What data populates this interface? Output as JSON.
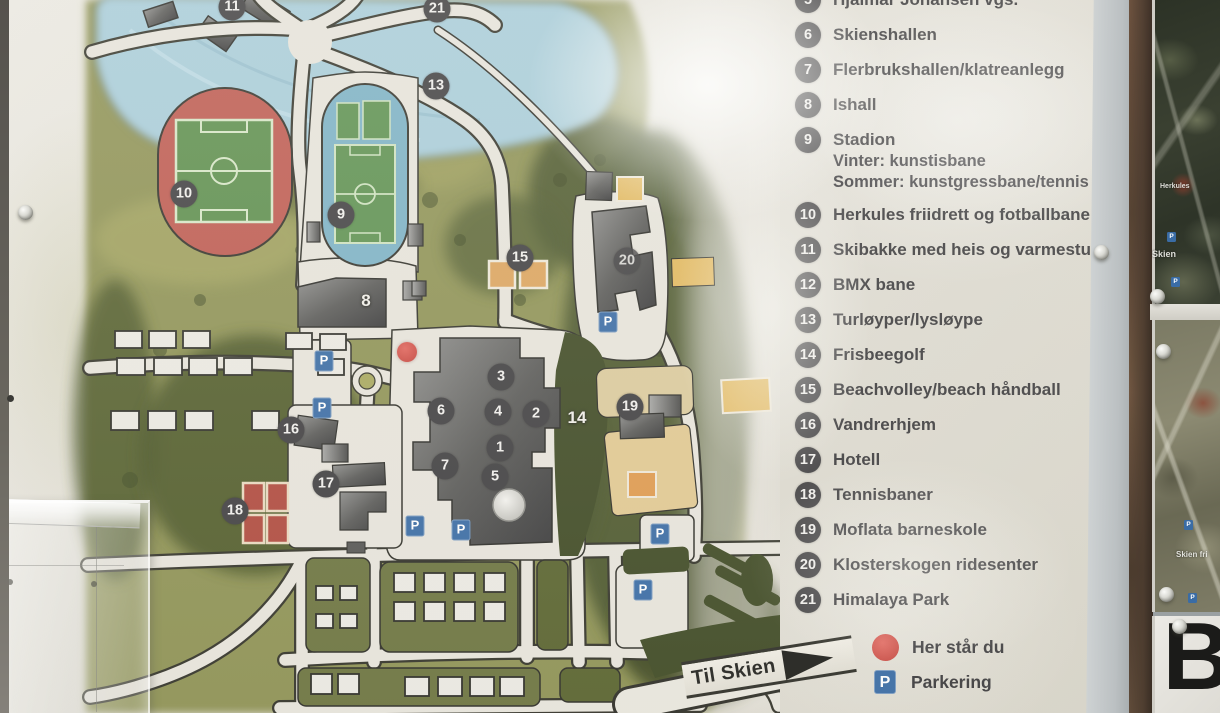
{
  "legend": {
    "items": [
      {
        "num": "5",
        "label": "Hjalmar Johansen vgs."
      },
      {
        "num": "6",
        "label": "Skienshallen"
      },
      {
        "num": "7",
        "label": "Flerbrukshallen/klatreanlegg"
      },
      {
        "num": "8",
        "label": "Ishall"
      },
      {
        "num": "9",
        "label": "Stadion",
        "sublines": [
          "Vinter: kunstisbane",
          "Sommer: kunstgressbane/tennis"
        ]
      },
      {
        "num": "10",
        "label": "Herkules friidrett og fotballbane"
      },
      {
        "num": "11",
        "label": "Skibakke med heis og varmestue"
      },
      {
        "num": "12",
        "label": "BMX bane"
      },
      {
        "num": "13",
        "label": "Turløyper/lysløype"
      },
      {
        "num": "14",
        "label": "Frisbeegolf"
      },
      {
        "num": "15",
        "label": "Beachvolley/beach håndball"
      },
      {
        "num": "16",
        "label": "Vandrerhjem"
      },
      {
        "num": "17",
        "label": "Hotell"
      },
      {
        "num": "18",
        "label": "Tennisbaner"
      },
      {
        "num": "19",
        "label": "Moflata barneskole"
      },
      {
        "num": "20",
        "label": "Klosterskogen ridesenter"
      },
      {
        "num": "21",
        "label": "Himalaya Park"
      }
    ],
    "you_are_here": "Her står du",
    "parking": "Parkering",
    "p_symbol": "P"
  },
  "map": {
    "til_skien": "Til Skien",
    "p_symbol": "P",
    "you_are_here": {
      "x": 407,
      "y": 352
    },
    "markers": [
      {
        "num": "11",
        "x": 232,
        "y": 7,
        "style": "badge"
      },
      {
        "num": "21",
        "x": 437,
        "y": 9,
        "style": "badge"
      },
      {
        "num": "13",
        "x": 436,
        "y": 86,
        "style": "badge"
      },
      {
        "num": "10",
        "x": 184,
        "y": 194,
        "style": "badge"
      },
      {
        "num": "9",
        "x": 341,
        "y": 215,
        "style": "badge"
      },
      {
        "num": "8",
        "x": 366,
        "y": 301,
        "style": "white"
      },
      {
        "num": "15",
        "x": 520,
        "y": 258,
        "style": "badge"
      },
      {
        "num": "20",
        "x": 627,
        "y": 261,
        "style": "badge-faded"
      },
      {
        "num": "3",
        "x": 501,
        "y": 377,
        "style": "badge"
      },
      {
        "num": "6",
        "x": 441,
        "y": 411,
        "style": "badge"
      },
      {
        "num": "4",
        "x": 498,
        "y": 412,
        "style": "badge"
      },
      {
        "num": "2",
        "x": 536,
        "y": 414,
        "style": "badge"
      },
      {
        "num": "14",
        "x": 577,
        "y": 418,
        "style": "white"
      },
      {
        "num": "19",
        "x": 630,
        "y": 407,
        "style": "badge"
      },
      {
        "num": "1",
        "x": 500,
        "y": 448,
        "style": "badge"
      },
      {
        "num": "7",
        "x": 445,
        "y": 466,
        "style": "badge"
      },
      {
        "num": "5",
        "x": 495,
        "y": 477,
        "style": "badge"
      },
      {
        "num": "16",
        "x": 291,
        "y": 430,
        "style": "badge"
      },
      {
        "num": "17",
        "x": 326,
        "y": 484,
        "style": "badge"
      },
      {
        "num": "18",
        "x": 235,
        "y": 511,
        "style": "badge"
      }
    ],
    "parking_signs": [
      {
        "x": 324,
        "y": 361
      },
      {
        "x": 322,
        "y": 408
      },
      {
        "x": 415,
        "y": 526
      },
      {
        "x": 461,
        "y": 530
      },
      {
        "x": 608,
        "y": 322
      },
      {
        "x": 660,
        "y": 534
      },
      {
        "x": 643,
        "y": 590
      }
    ]
  },
  "side_panels": {
    "panel1_labels": [
      {
        "text": "Herkules",
        "x": 1160,
        "y": 183,
        "size": 7
      },
      {
        "text": "Skien",
        "x": 1152,
        "y": 249,
        "size": 9
      }
    ],
    "panel1_p_dots": [
      {
        "x": 1167,
        "y": 232
      },
      {
        "x": 1171,
        "y": 277
      }
    ],
    "panel2_labels": [
      {
        "text": "Skien fri",
        "x": 1176,
        "y": 550,
        "size": 8
      }
    ],
    "panel2_p_dots": [
      {
        "x": 1184,
        "y": 520
      },
      {
        "x": 1188,
        "y": 593
      }
    ],
    "panel3_letter": "B"
  },
  "colors": {
    "badge": "#403f41",
    "parking_blue": "#3a6ca5",
    "you_are_here_red": "#cb4a42",
    "track_red": "#bf5a50",
    "stadium_blue": "#7cb2c6",
    "field_green": "#5d8f4d",
    "forest_dark": "#46522a",
    "paper": "#e2dfd6"
  }
}
